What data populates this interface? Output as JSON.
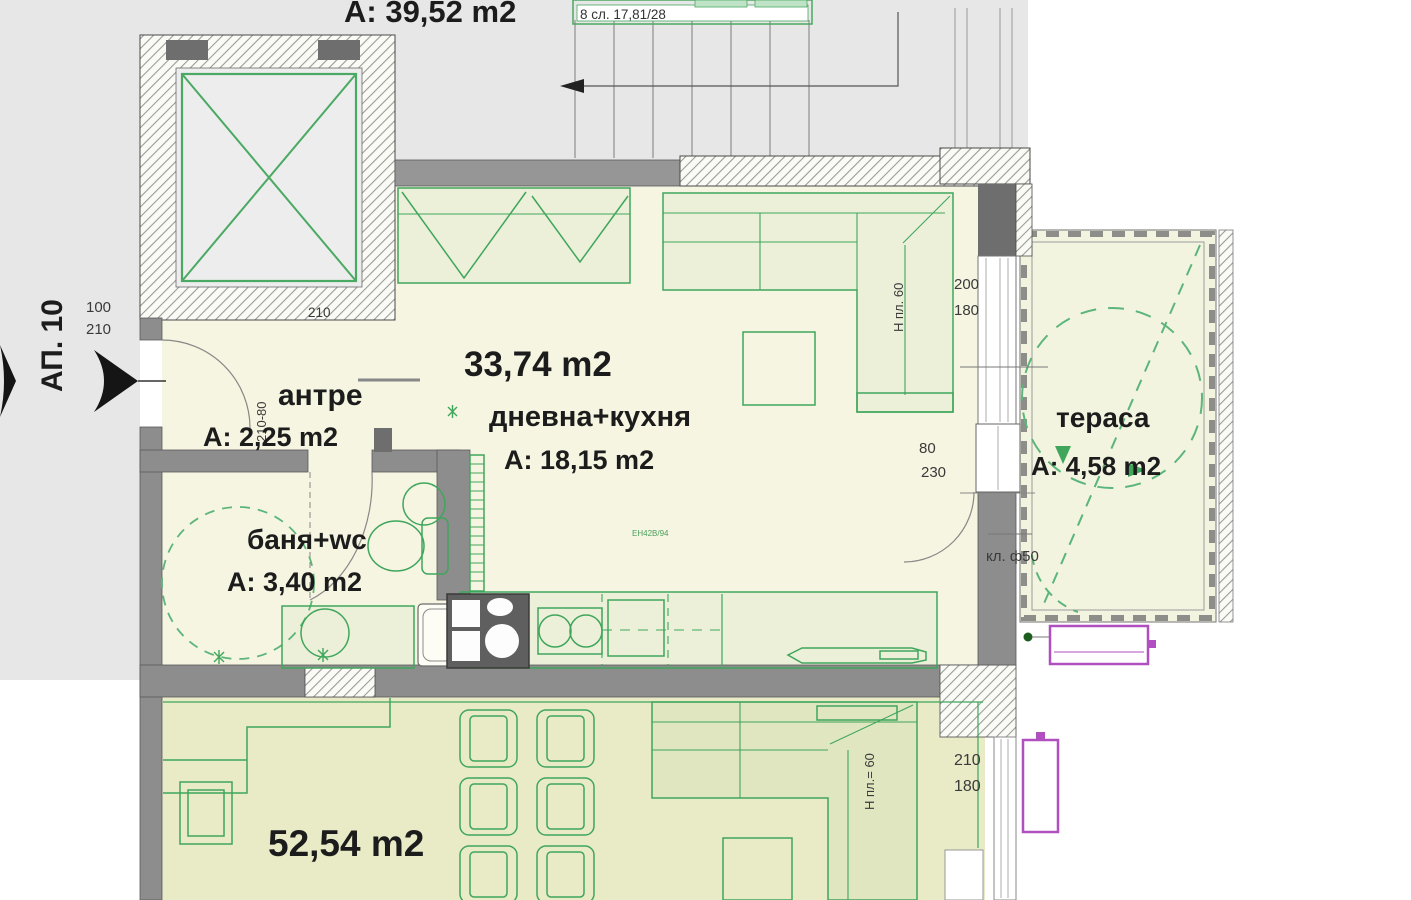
{
  "labels": {
    "apartment": "АП. 10",
    "upper_apartment_area": "A: 39,52 m2",
    "stairs": "8 сл. 17,81/28",
    "sofa_model": "ЕН42В/94"
  },
  "rooms": {
    "antre": {
      "name": "антре",
      "area": "A: 2,25 m2"
    },
    "living": {
      "total": "33,74 m2",
      "name": "дневна+кухня",
      "area": "A: 18,15 m2"
    },
    "bathroom": {
      "name": "баня+wc",
      "area": "A: 3,40 m2"
    },
    "terrace": {
      "name": "тераса",
      "area": "A: 4,58 m2"
    },
    "lower_apartment": {
      "area": "52,54 m2"
    }
  },
  "dims": {
    "entrance_w": "100",
    "entrance_h": "210",
    "elevator_w": "210",
    "antre_door": "210-80",
    "living_window_w": "200",
    "living_window_h": "180",
    "terrace_door_w": "80",
    "terrace_door_h": "230",
    "lower_window_w": "210",
    "lower_window_h": "180",
    "ac_unit": "кл. ф50",
    "sofa_height_living": "Н пл. 60",
    "sofa_height_lower": "Н пл.= 60"
  },
  "colors": {
    "furniture_green": "#3fa65c",
    "dashed_green": "#5cb57a",
    "wall_gray": "#8d8d8d",
    "radiator_magenta": "#b04fc0",
    "interior_cream": "#f6f5e1",
    "lower_room_fill": "#e8ebc6",
    "common_gray": "#e7e7e7"
  }
}
